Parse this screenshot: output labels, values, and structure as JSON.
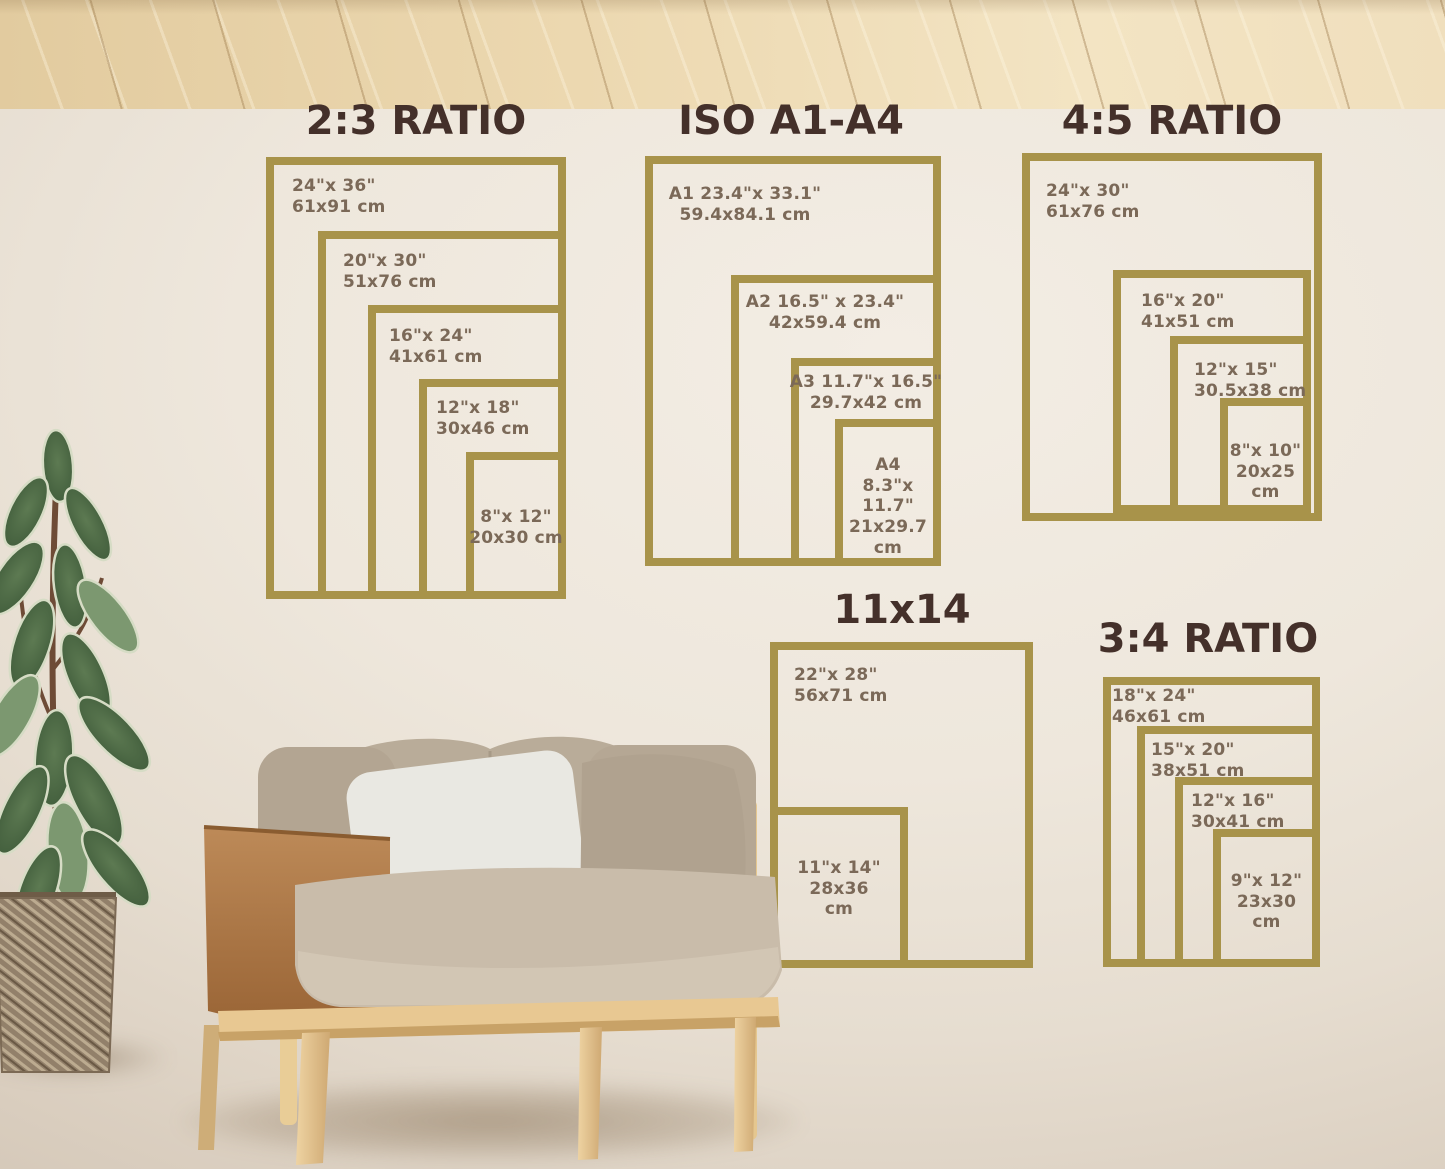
{
  "palette": {
    "frame_gold": "#a8934a",
    "heading_brown": "#44302a",
    "label_brown": "#7b6958",
    "wall_cream": "#eee7dc",
    "floor_wood": "#ecd8b0",
    "chair_wood": "#e9cd97",
    "leather_tan": "#ab7a46",
    "cushion_taupe": "#c0b3a0",
    "pillow_white": "#e9e8e2",
    "leaf_green": "#465f40"
  },
  "groups": [
    {
      "title": "2:3 RATIO",
      "frames": [
        {
          "lines": [
            "24\"x 36\"",
            "61x91 cm"
          ]
        },
        {
          "lines": [
            "20\"x 30\"",
            "51x76 cm"
          ]
        },
        {
          "lines": [
            "16\"x 24\"",
            "41x61 cm"
          ]
        },
        {
          "lines": [
            "12\"x 18\"",
            "30x46 cm"
          ]
        },
        {
          "lines": [
            "8\"x 12\"",
            "20x30 cm"
          ]
        }
      ]
    },
    {
      "title": "ISO A1-A4",
      "frames": [
        {
          "lines": [
            "A1 23.4\"x 33.1\"",
            "59.4x84.1 cm"
          ]
        },
        {
          "lines": [
            "A2 16.5\" x 23.4\"",
            "42x59.4 cm"
          ]
        },
        {
          "lines": [
            "A3 11.7\"x 16.5\"",
            "29.7x42 cm"
          ]
        },
        {
          "lines": [
            "A4",
            "8.3\"x 11.7\"",
            "21x29.7",
            "cm"
          ]
        }
      ]
    },
    {
      "title": "4:5 RATIO",
      "frames": [
        {
          "lines": [
            "24\"x 30\"",
            "61x76 cm"
          ]
        },
        {
          "lines": [
            "16\"x 20\"",
            "41x51 cm"
          ]
        },
        {
          "lines": [
            "12\"x 15\"",
            "30.5x38 cm"
          ]
        },
        {
          "lines": [
            "8\"x 10\"",
            "20x25",
            "cm"
          ]
        }
      ]
    },
    {
      "title": "11x14",
      "frames": [
        {
          "lines": [
            "22\"x 28\"",
            "56x71 cm"
          ]
        },
        {
          "lines": [
            "11\"x 14\"",
            "28x36",
            "cm"
          ]
        }
      ]
    },
    {
      "title": "3:4 RATIO",
      "frames": [
        {
          "lines": [
            "18\"x 24\"",
            "46x61 cm"
          ]
        },
        {
          "lines": [
            "15\"x 20\"",
            "38x51 cm"
          ]
        },
        {
          "lines": [
            "12\"x 16\"",
            "30x41 cm"
          ]
        },
        {
          "lines": [
            "9\"x 12\"",
            "23x30",
            "cm"
          ]
        }
      ]
    }
  ]
}
